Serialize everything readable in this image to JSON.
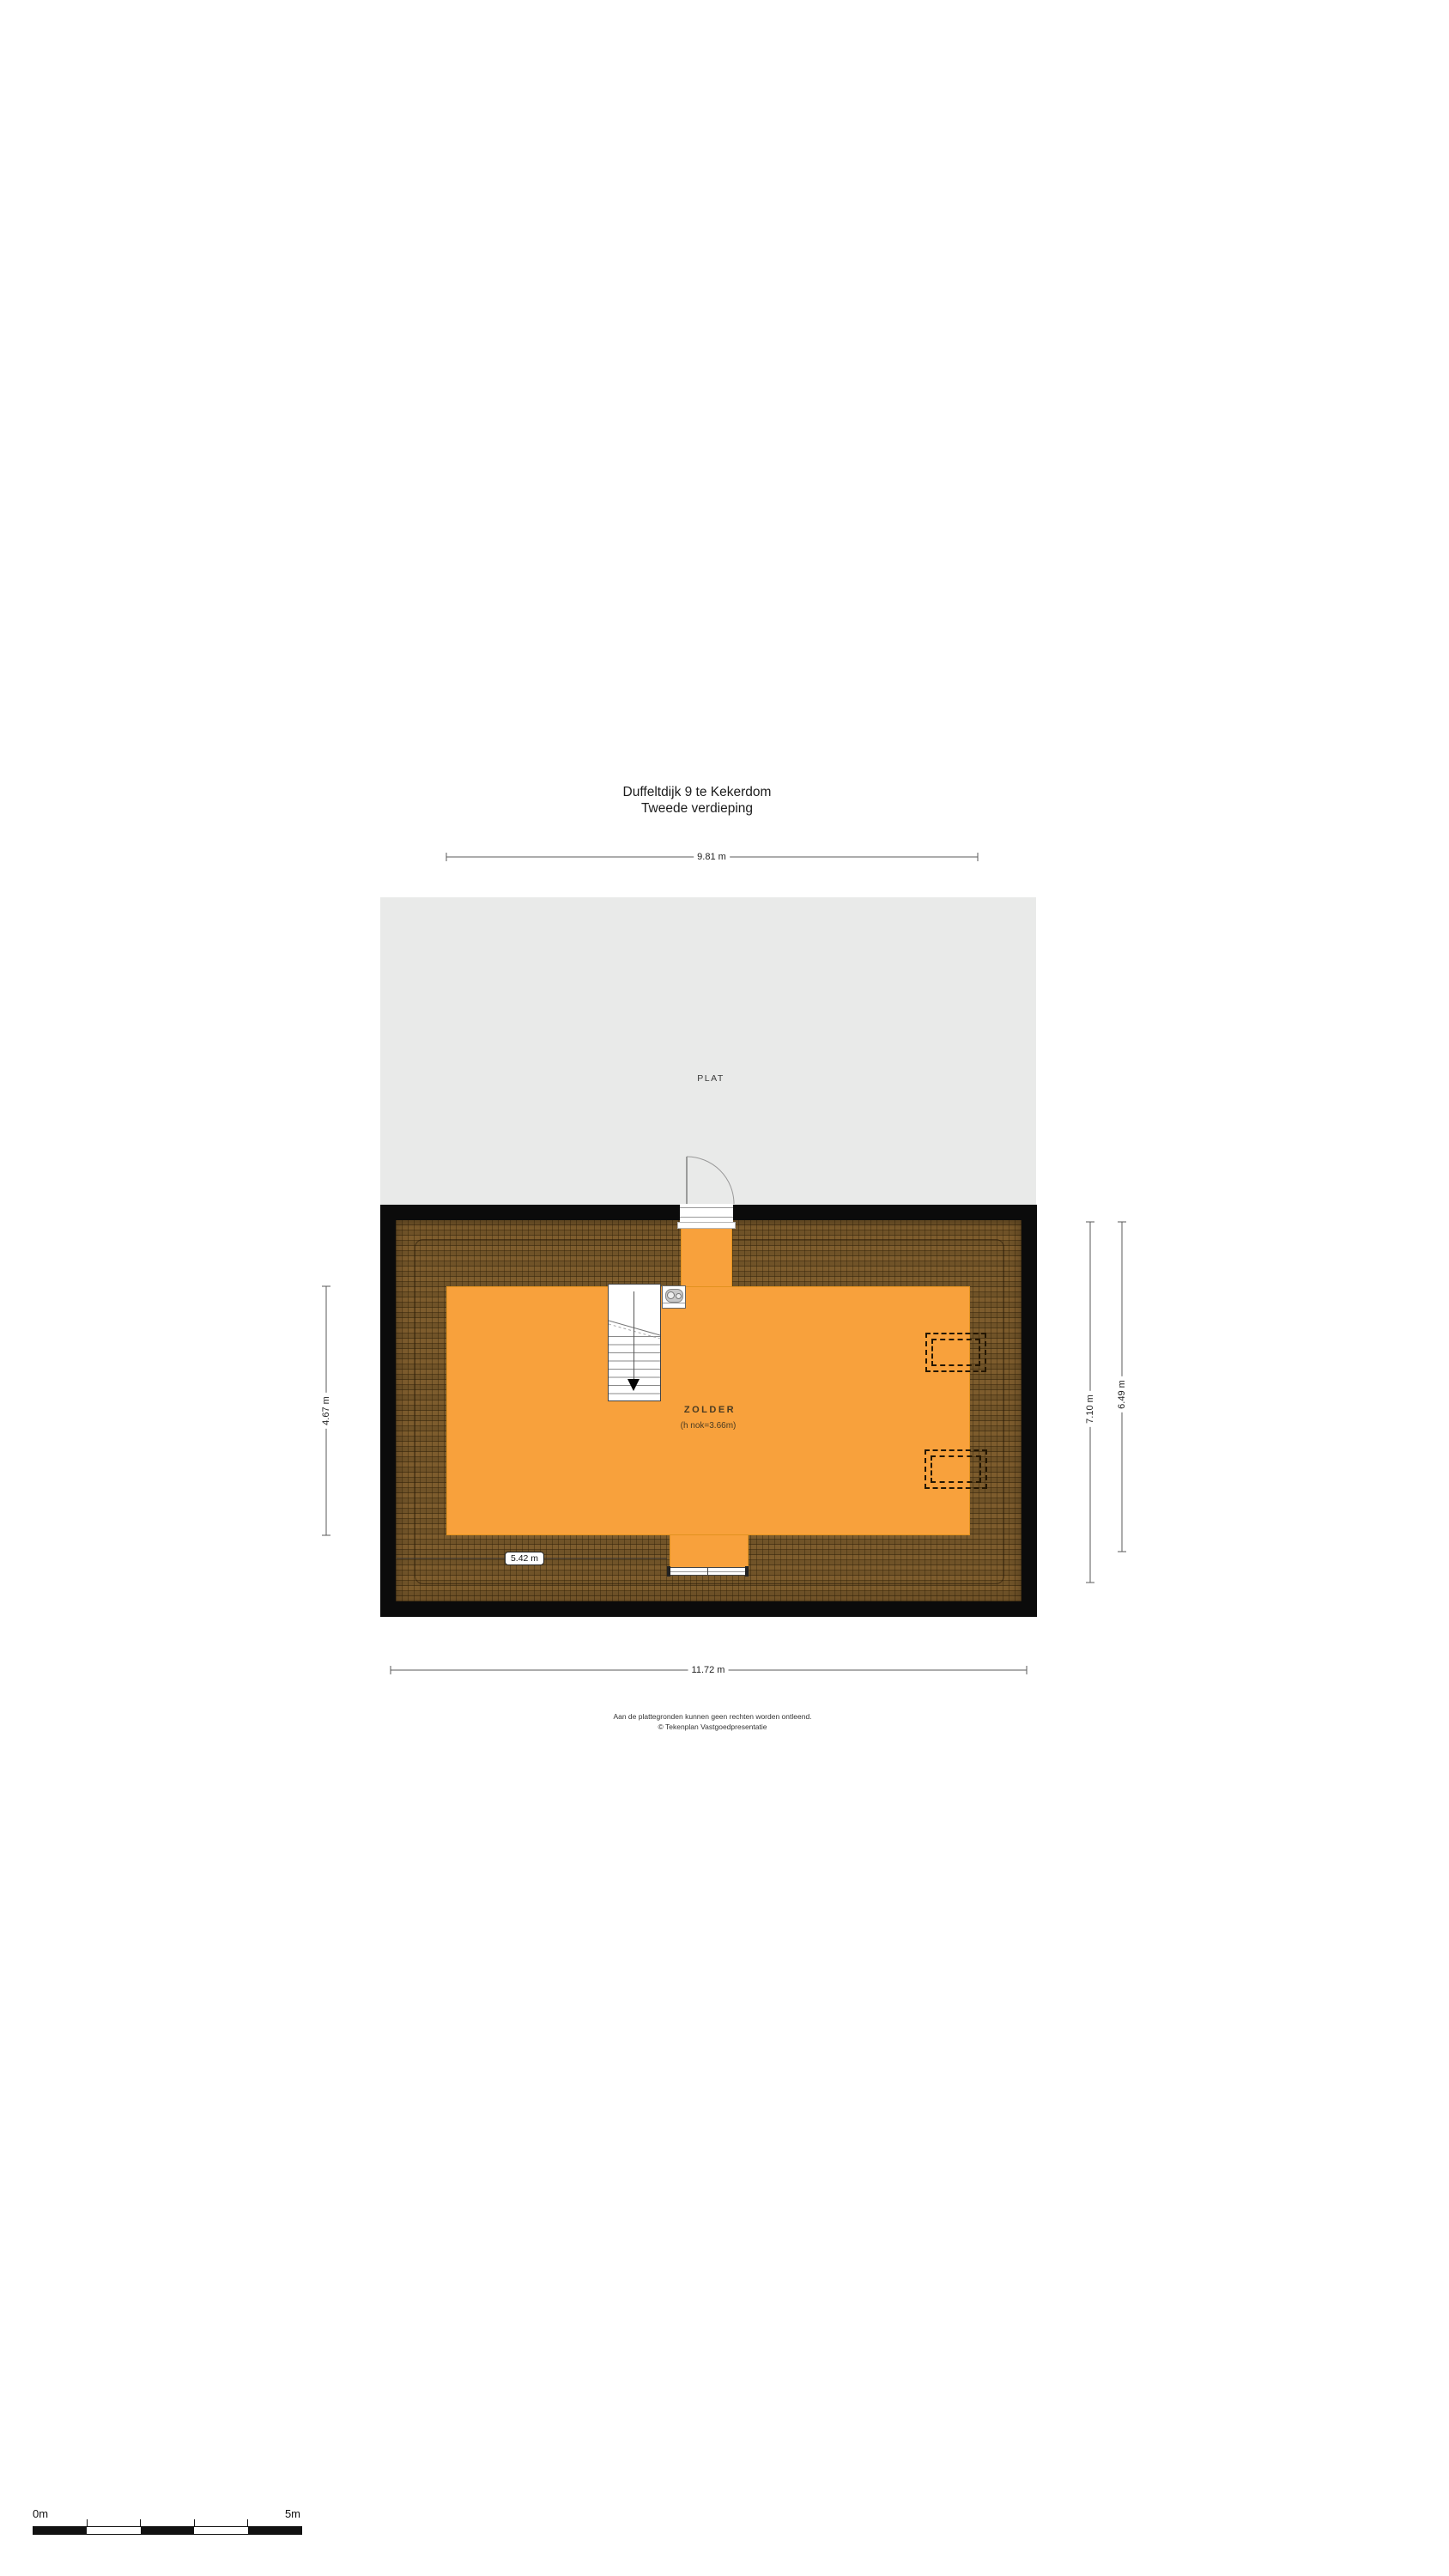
{
  "page": {
    "title_line1": "Duffeltdijk 9 te Kekerdom",
    "title_line2": "Tweede verdieping"
  },
  "rooms": {
    "flat_roof": {
      "label": "PLAT"
    },
    "attic": {
      "label": "ZOLDER",
      "sublabel": "(h nok=3.66m)"
    }
  },
  "dimensions": {
    "top_width": "9.81 m",
    "left_height": "4.67 m",
    "right_outer_height": "7.10 m",
    "right_inner_height": "6.49 m",
    "bottom_width": "11.72 m",
    "interior_width": "5.42 m"
  },
  "scale_bar": {
    "start_label": "0m",
    "end_label": "5m"
  },
  "footer": {
    "line1": "Aan de plattegronden kunnen geen rechten worden ontleend.",
    "line2": "© Tekenplan Vastgoedpresentatie"
  },
  "colors": {
    "attic_orange": "#f8a13c",
    "roof_brown": "#7d5c2d",
    "wall_black": "#0b0b0b",
    "flat_roof_gray": "#e9eae9"
  }
}
